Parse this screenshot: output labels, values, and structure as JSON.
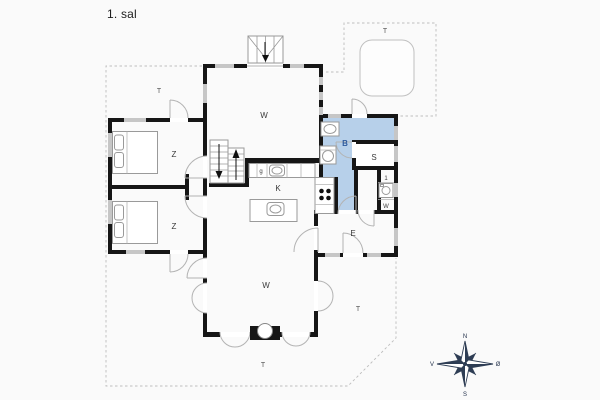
{
  "title": "1. sal",
  "colors": {
    "bathroom": "#b7d0ea",
    "bathroom_label": "#2f5b9e",
    "compass": "#2e3d54"
  },
  "rooms": {
    "w_top": "W",
    "z1": "Z",
    "z2": "Z",
    "bathroom": "B",
    "s": "S",
    "kitchen": "K",
    "entry": "E",
    "w_bottom": "W",
    "utility_top": "1",
    "utility_bottom": "W",
    "counter_glyph": "g"
  },
  "terraces": {
    "top_left": "T",
    "top_right": "T",
    "right": "T",
    "bottom": "T"
  },
  "compass": {
    "n": "N",
    "s": "S",
    "w": "V",
    "e": "Ø"
  }
}
